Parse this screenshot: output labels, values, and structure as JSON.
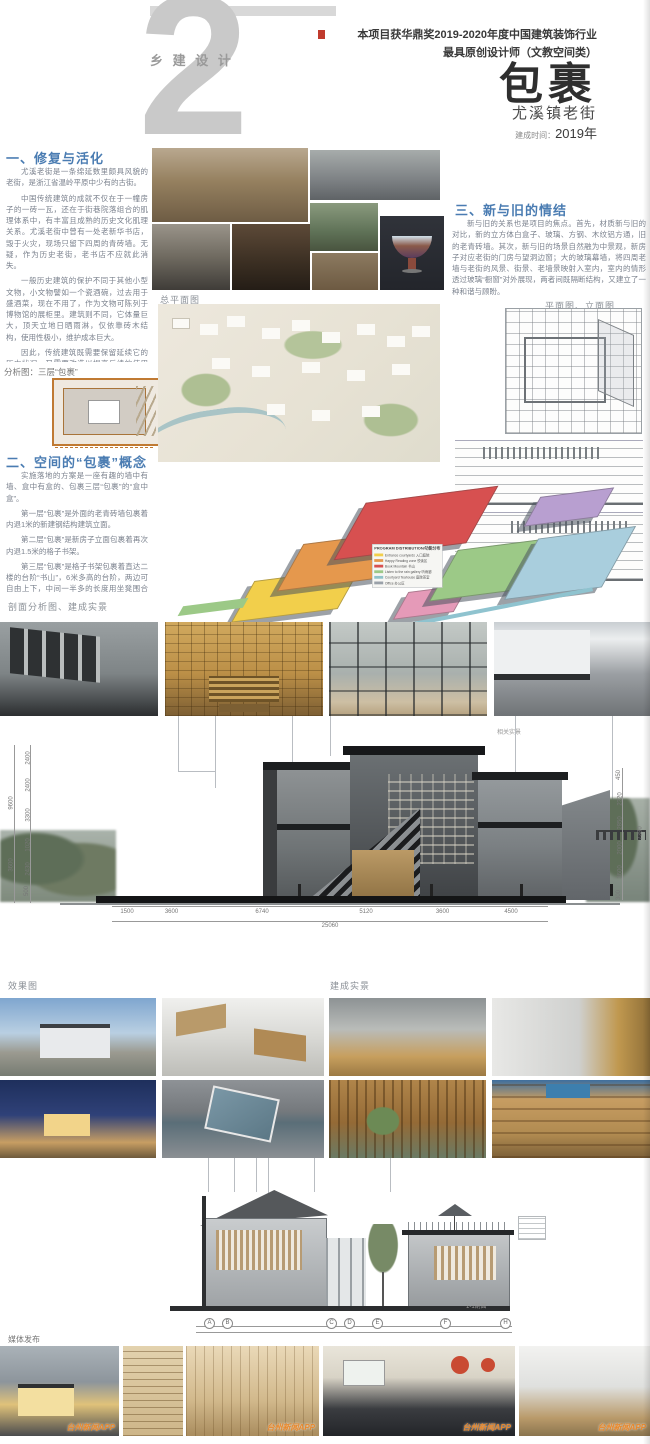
{
  "page": {
    "background": "#ffffff",
    "accent_blue": "#4a7cb2",
    "watermark_orange": "#e8882c"
  },
  "header": {
    "number": "2",
    "series": "乡 建 设 计",
    "award_line1": "本项目获华鼎奖2019-2020年度中国建筑装饰行业",
    "award_line2": "最具原创设计师（文教空间类）",
    "title": "包裹",
    "subtitle": "尤溪镇老街",
    "built_label": "建成时间：",
    "built_year": "2019年"
  },
  "sections": {
    "s1": {
      "heading": "一、修复与活化",
      "paragraphs": [
        "尤溪老街是一条绵延数里颇具风貌的老街，是浙江省温岭平原中少有的古街。",
        "中国传统建筑的成就不仅在于一幢房子的一砖一瓦，还在于街巷院落组合的肌理体系中，有丰富且成熟的历史文化肌理关系。尤溪老街中曾有一处老新华书店，毁于火灾，现场只留下四周的青砖墙。无疑，作为历史老街，老书店不应就此消失。",
        "一般历史建筑的保护不同于其他小型文物，小文物譬如一个瓷酒碗，过去用于盛酒菜，现在不用了，作为文物可陈列于博物馆的展柜里。建筑则不同，它体量巨大，顶天立地日晒雨淋，仅依靠砖木结构，使用性极小，维护成本巨大。",
        "因此，传统建筑既需要保留延续它的历史状况，又需要改造以提高后续的使用效率。此案，我们首先采用一种“活化修复”法，保留现场历史遗存——四周的老青砖墙，墙内侧采用钢结构建筑，新建空间作为县图书馆尤溪分馆，成为一处公共阅读空间、学习的场地，也作为小型讲座、小型展会沙龙的场所。"
      ]
    },
    "analysis_label": "分析图：三层“包裹”",
    "s2": {
      "heading": "二、空间的“包裹”概念",
      "paragraphs": [
        "实施落地的方案是一座有趣的墙中有墙、盒中有盒的、包裹三层“包裹”的“盒中盒”。",
        "第一层“包裹”是外面的老青砖墙包裹着内退1米的新建钢结构建筑立面。",
        "第二层“包裹”是新房子立面包裹着再次内退1.5米的格子书架。",
        "第三层“包裹”是格子书架包裹着直达二楼的台阶“书山”，6米多高的台阶，两边可自由上下，中间一半多的长度用坐凳围合为一个长式书桌，一面摆书，一面可供读者坐着看书。",
        "三层包裹带出了空间与通道，形成了空间的层叠与递进，让光影随季节流转，营造了场所的灵动与静谧、明亮与斑驳、直白与含蓄。"
      ]
    },
    "s3": {
      "heading": "三、新与旧的情结",
      "paragraph": "新与旧的关系也是项目的焦点。首先，材质新与旧的对比，新的立方体白盒子、玻璃、方钢、木纹铝方通，旧的老青砖墙。其次，新与旧的场景自然融为中景观，新房子对应老街的门房与望洞边窗；大的玻璃幕墙，将四周老墙与老街的风景、街景、老墙景映射入室内，室内的情形透过玻璃“橱窗”对外展现，两者间既隔断结构，又建立了一种和谐与顾盼。"
    },
    "labels": {
      "site_plan": "总平面图",
      "plan_elev": "平面图、立面图",
      "section_analysis": "剖面分析图、建成实景",
      "related": "相关实景",
      "render": "效果图",
      "built": "建成实景",
      "section_ref": "1-1剖面",
      "media": "媒体发布"
    }
  },
  "legend": {
    "title": "PROGRAM DISTRIBUTION/功能分布",
    "items": [
      {
        "label": "Entrance courtyards 入口庭院",
        "color": "#f2cf4b"
      },
      {
        "label": "Happy Reading zone 悦读区",
        "color": "#e5984d"
      },
      {
        "label": "Book Mountain 书山",
        "color": "#d75050"
      },
      {
        "label": "Listen to the rain gallery 听雨廊",
        "color": "#9cc987"
      },
      {
        "label": "Courtyard Teahouse 庭院茶室",
        "color": "#8fc3c9"
      },
      {
        "label": "Office 办公区",
        "color": "#9aa1a9"
      }
    ]
  },
  "section_drawing": {
    "dims_bottom": [
      "1500",
      "3600",
      "6740",
      "5120",
      "3600",
      "4500"
    ],
    "dims_total": "25060",
    "dims_left": [
      "2400",
      "2400",
      "3300",
      "1020",
      "2430",
      "500"
    ],
    "dims_left_outer": [
      "9600",
      "3600"
    ],
    "dims_right": [
      "450",
      "2320",
      "2850",
      "2000",
      "3600",
      "300"
    ],
    "dims_right_outer": "7380"
  },
  "small_section": {
    "bubbles": [
      "A",
      "B",
      "C",
      "D",
      "E",
      "F",
      "H"
    ]
  },
  "watermark": "台州新闻APP"
}
